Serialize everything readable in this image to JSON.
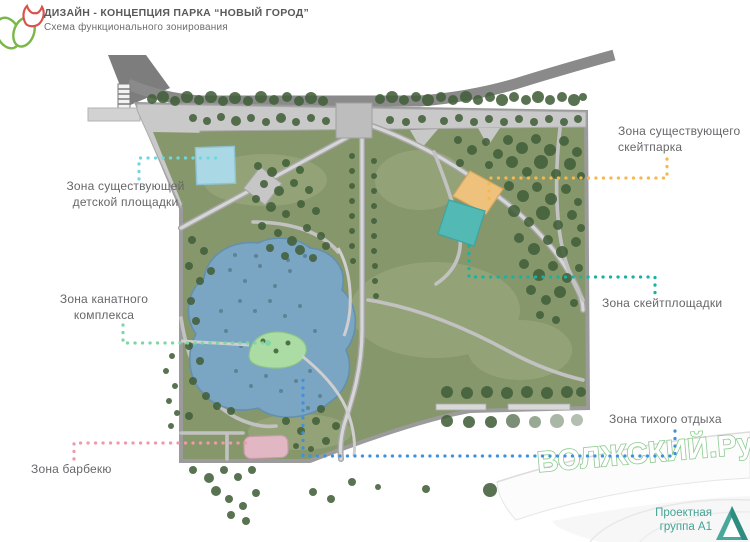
{
  "header": {
    "title": "ДИЗАЙН - КОНЦЕПЦИЯ ПАРКА “НОВЫЙ ГОРОД”",
    "subtitle": "Схема функционального зонирования"
  },
  "zones": {
    "playground": {
      "label": "Зона существующей\nдетской площадки",
      "fill": "#aad8e4",
      "stroke": "#8ec2d2",
      "line": "#6ed8de"
    },
    "skatepark_existing": {
      "label": "Зона существующего\nскейтпарка",
      "fill": "#eec27d",
      "stroke": "#d9a85f",
      "line": "#f5b84f"
    },
    "skate_area": {
      "label": "Зона скейтплощадки",
      "fill": "#53b9b4",
      "stroke": "#3da49f",
      "line": "#17b3a2"
    },
    "rope": {
      "label": "Зона канатного\nкомплекса",
      "fill": "#abdca4",
      "stroke": "#8cc387",
      "line": "#7fd6a4"
    },
    "bbq": {
      "label": "Зона барбекю",
      "fill": "#e2b7c4",
      "stroke": "#c79aa9",
      "line": "#ef9aa9"
    },
    "quiet": {
      "label": "Зона тихого отдыха",
      "line": "#4090dc"
    }
  },
  "watermark": {
    "text": "ВОЛЖСКИЙ.Ру",
    "fill": "#ffffff",
    "stroke": "#8bcb8e"
  },
  "footer": {
    "line1": "Проектная",
    "line2": "группа А1",
    "color": "#44a294"
  },
  "map": {
    "lawn": "#87976c",
    "road": "#8a8a8a",
    "plaza": "#bdbdbd",
    "pond_fill": "#7aa6c4",
    "pond_stroke": "#6490ad",
    "tree_color": "#42603a",
    "speckle_color": "#47626f",
    "trees": [
      [
        152,
        99,
        5
      ],
      [
        163,
        97,
        6
      ],
      [
        175,
        101,
        5
      ],
      [
        187,
        97,
        6
      ],
      [
        199,
        100,
        5
      ],
      [
        211,
        97,
        6
      ],
      [
        223,
        101,
        5
      ],
      [
        235,
        98,
        6
      ],
      [
        248,
        101,
        5
      ],
      [
        261,
        97,
        6
      ],
      [
        274,
        100,
        5
      ],
      [
        287,
        97,
        5
      ],
      [
        299,
        101,
        5
      ],
      [
        311,
        98,
        6
      ],
      [
        323,
        101,
        5
      ],
      [
        380,
        99,
        5
      ],
      [
        392,
        97,
        6
      ],
      [
        404,
        100,
        5
      ],
      [
        416,
        97,
        5
      ],
      [
        428,
        100,
        6
      ],
      [
        441,
        97,
        5
      ],
      [
        453,
        100,
        5
      ],
      [
        466,
        97,
        6
      ],
      [
        478,
        100,
        5
      ],
      [
        490,
        97,
        5
      ],
      [
        502,
        100,
        6
      ],
      [
        514,
        97,
        5
      ],
      [
        526,
        100,
        5
      ],
      [
        538,
        97,
        6
      ],
      [
        550,
        100,
        5
      ],
      [
        562,
        97,
        5
      ],
      [
        574,
        100,
        6
      ],
      [
        583,
        97,
        4
      ],
      [
        193,
        118,
        4
      ],
      [
        207,
        121,
        4
      ],
      [
        221,
        117,
        4
      ],
      [
        236,
        121,
        5
      ],
      [
        251,
        118,
        4
      ],
      [
        266,
        122,
        4
      ],
      [
        281,
        118,
        5
      ],
      [
        296,
        122,
        4
      ],
      [
        311,
        118,
        4
      ],
      [
        326,
        121,
        4
      ],
      [
        390,
        120,
        4
      ],
      [
        406,
        122,
        4
      ],
      [
        422,
        119,
        4
      ],
      [
        444,
        121,
        4
      ],
      [
        459,
        118,
        4
      ],
      [
        474,
        122,
        4
      ],
      [
        489,
        119,
        4
      ],
      [
        504,
        122,
        4
      ],
      [
        519,
        119,
        4
      ],
      [
        534,
        122,
        4
      ],
      [
        549,
        119,
        4
      ],
      [
        564,
        122,
        4
      ],
      [
        578,
        119,
        4
      ],
      [
        508,
        140,
        5
      ],
      [
        522,
        148,
        6
      ],
      [
        536,
        139,
        5
      ],
      [
        550,
        150,
        6
      ],
      [
        564,
        141,
        5
      ],
      [
        577,
        152,
        5
      ],
      [
        512,
        162,
        6
      ],
      [
        527,
        172,
        5
      ],
      [
        541,
        162,
        7
      ],
      [
        556,
        174,
        5
      ],
      [
        570,
        164,
        6
      ],
      [
        581,
        176,
        4
      ],
      [
        509,
        186,
        5
      ],
      [
        523,
        196,
        6
      ],
      [
        537,
        187,
        5
      ],
      [
        551,
        199,
        6
      ],
      [
        566,
        189,
        5
      ],
      [
        578,
        202,
        4
      ],
      [
        514,
        211,
        6
      ],
      [
        529,
        222,
        5
      ],
      [
        543,
        213,
        7
      ],
      [
        558,
        225,
        5
      ],
      [
        572,
        215,
        5
      ],
      [
        581,
        228,
        4
      ],
      [
        519,
        238,
        5
      ],
      [
        534,
        249,
        6
      ],
      [
        548,
        240,
        5
      ],
      [
        562,
        252,
        6
      ],
      [
        576,
        242,
        5
      ],
      [
        524,
        264,
        5
      ],
      [
        539,
        275,
        6
      ],
      [
        553,
        266,
        5
      ],
      [
        567,
        278,
        5
      ],
      [
        579,
        268,
        4
      ],
      [
        531,
        290,
        5
      ],
      [
        546,
        300,
        5
      ],
      [
        560,
        292,
        6
      ],
      [
        574,
        303,
        4
      ],
      [
        540,
        315,
        4
      ],
      [
        556,
        320,
        4
      ],
      [
        458,
        140,
        4
      ],
      [
        472,
        150,
        5
      ],
      [
        486,
        142,
        4
      ],
      [
        498,
        154,
        5
      ],
      [
        460,
        163,
        4
      ],
      [
        489,
        165,
        4
      ],
      [
        258,
        166,
        4
      ],
      [
        272,
        172,
        5
      ],
      [
        286,
        163,
        4
      ],
      [
        300,
        170,
        4
      ],
      [
        264,
        184,
        4
      ],
      [
        279,
        191,
        5
      ],
      [
        294,
        183,
        4
      ],
      [
        309,
        190,
        4
      ],
      [
        256,
        199,
        4
      ],
      [
        271,
        207,
        5
      ],
      [
        286,
        214,
        4
      ],
      [
        301,
        204,
        4
      ],
      [
        316,
        211,
        4
      ],
      [
        262,
        226,
        4
      ],
      [
        278,
        233,
        4
      ],
      [
        292,
        241,
        5
      ],
      [
        307,
        228,
        4
      ],
      [
        321,
        236,
        4
      ],
      [
        270,
        248,
        4
      ],
      [
        285,
        256,
        4
      ],
      [
        300,
        250,
        5
      ],
      [
        313,
        258,
        4
      ],
      [
        326,
        246,
        4
      ],
      [
        352,
        156,
        3
      ],
      [
        374,
        161,
        3
      ],
      [
        352,
        171,
        3
      ],
      [
        374,
        176,
        3
      ],
      [
        352,
        186,
        3
      ],
      [
        374,
        191,
        3
      ],
      [
        352,
        201,
        3
      ],
      [
        374,
        206,
        3
      ],
      [
        352,
        216,
        3
      ],
      [
        374,
        221,
        3
      ],
      [
        352,
        231,
        3
      ],
      [
        374,
        236,
        3
      ],
      [
        352,
        246,
        3
      ],
      [
        374,
        251,
        3
      ],
      [
        353,
        261,
        3
      ],
      [
        375,
        266,
        3
      ],
      [
        375,
        281,
        3
      ],
      [
        376,
        296,
        3
      ],
      [
        192,
        240,
        4
      ],
      [
        204,
        251,
        4
      ],
      [
        189,
        266,
        4
      ],
      [
        200,
        281,
        4
      ],
      [
        211,
        271,
        4
      ],
      [
        191,
        301,
        4
      ],
      [
        196,
        321,
        4
      ],
      [
        189,
        346,
        4
      ],
      [
        200,
        361,
        4
      ],
      [
        193,
        381,
        4
      ],
      [
        206,
        396,
        4
      ],
      [
        217,
        406,
        4
      ],
      [
        231,
        411,
        4
      ],
      [
        189,
        416,
        4
      ],
      [
        286,
        421,
        4
      ],
      [
        301,
        431,
        4
      ],
      [
        316,
        421,
        4
      ],
      [
        296,
        446,
        3
      ],
      [
        311,
        449,
        3
      ],
      [
        326,
        441,
        4
      ],
      [
        321,
        409,
        4
      ],
      [
        336,
        426,
        4
      ],
      [
        447,
        392,
        6
      ],
      [
        467,
        393,
        6
      ],
      [
        487,
        392,
        6
      ],
      [
        507,
        393,
        6
      ],
      [
        527,
        392,
        6
      ],
      [
        547,
        393,
        6
      ],
      [
        567,
        392,
        6
      ],
      [
        581,
        392,
        5
      ],
      [
        447,
        421,
        6
      ],
      [
        469,
        422,
        6
      ],
      [
        491,
        422,
        6
      ],
      [
        513,
        421,
        7,
        0.7
      ],
      [
        535,
        422,
        6,
        0.55
      ],
      [
        557,
        421,
        7,
        0.45
      ],
      [
        577,
        420,
        6,
        0.4
      ],
      [
        193,
        470,
        4
      ],
      [
        209,
        478,
        5
      ],
      [
        224,
        470,
        4
      ],
      [
        238,
        477,
        4
      ],
      [
        252,
        470,
        4
      ],
      [
        216,
        491,
        5
      ],
      [
        229,
        499,
        4
      ],
      [
        243,
        506,
        4
      ],
      [
        256,
        493,
        4
      ],
      [
        231,
        515,
        4
      ],
      [
        246,
        521,
        4
      ],
      [
        313,
        492,
        4
      ],
      [
        331,
        499,
        4
      ],
      [
        352,
        482,
        4
      ],
      [
        378,
        487,
        3
      ],
      [
        426,
        489,
        4
      ],
      [
        490,
        490,
        7
      ],
      [
        575,
        470,
        6,
        0.5
      ],
      [
        172,
        356,
        3
      ],
      [
        166,
        371,
        3
      ],
      [
        175,
        386,
        3
      ],
      [
        169,
        401,
        3
      ],
      [
        177,
        413,
        3
      ],
      [
        171,
        426,
        3
      ],
      [
        263,
        341,
        2.5
      ],
      [
        276,
        351,
        2.5
      ],
      [
        288,
        343,
        2.5
      ]
    ],
    "speckles": [
      [
        230,
        270
      ],
      [
        245,
        281
      ],
      [
        260,
        266
      ],
      [
        275,
        286
      ],
      [
        290,
        271
      ],
      [
        240,
        301
      ],
      [
        255,
        311
      ],
      [
        270,
        301
      ],
      [
        285,
        316
      ],
      [
        300,
        306
      ],
      [
        226,
        331
      ],
      [
        241,
        346
      ],
      [
        300,
        341
      ],
      [
        315,
        331
      ],
      [
        236,
        371
      ],
      [
        251,
        386
      ],
      [
        266,
        376
      ],
      [
        281,
        391
      ],
      [
        296,
        381
      ],
      [
        310,
        371
      ],
      [
        320,
        396
      ],
      [
        256,
        256
      ],
      [
        305,
        256
      ],
      [
        221,
        311
      ],
      [
        308,
        408
      ],
      [
        288,
        260
      ],
      [
        235,
        255
      ]
    ]
  }
}
